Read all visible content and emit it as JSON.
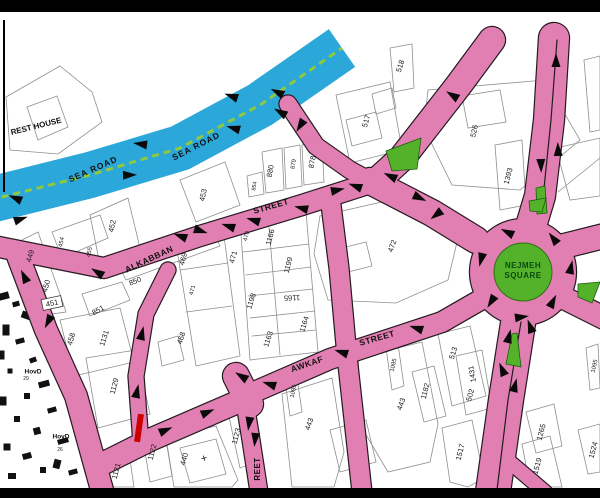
{
  "colors": {
    "road_pink": "#e27fb2",
    "casing": "#241a20",
    "sea_blue": "#2ba7da",
    "dash_green": "#8fc93e",
    "island_green": "#54b22a",
    "nejmeh_text": "#0b4a0e",
    "parcel_line": "#8f8f8f",
    "label": "#1c1c1c",
    "red": "#cc0000",
    "bar": "#000000",
    "paper": "#ffffff"
  },
  "map": {
    "sea_road": {
      "pts": "-10,200 90,175 180,148 260,105 342,48",
      "w": 46,
      "dash_w": 3,
      "dash_pattern": "7 5"
    },
    "roads": [
      {
        "pts": "-6,246 104,268 200,236 302,205 374,182",
        "w": 20
      },
      {
        "pts": "18,256 46,330 76,396 102,490",
        "w": 22
      },
      {
        "pts": "98,466 152,439 240,401",
        "w": 22
      },
      {
        "pts": "238,399 330,359 442,322 482,299",
        "w": 20
      },
      {
        "pts": "236,376 250,404",
        "w": 26
      },
      {
        "pts": "168,270 146,314 136,376 141,444",
        "w": 15
      },
      {
        "pts": "330,197 339,268 347,356 362,492",
        "w": 19
      },
      {
        "pts": "244,397 251,440 259,492",
        "w": 17
      },
      {
        "pts": "288,104 316,146 350,170 374,183",
        "w": 17
      },
      {
        "pts": "492,40 458,86 402,158 380,178",
        "w": 26
      },
      {
        "pts": "370,181 432,213 476,240",
        "w": 26
      },
      {
        "pts": "554,38 549,120 540,196 531,226",
        "w": 30
      },
      {
        "pts": "548,250 604,236",
        "w": 24
      },
      {
        "pts": "548,290 604,318",
        "w": 22
      },
      {
        "pts": "519,317 506,400 493,492",
        "w": 34
      },
      {
        "pts": "505,458 545,492",
        "w": 14
      }
    ],
    "center_lines": [
      {
        "pts": "557,40 551,120 543,198",
        "w": 1.2
      },
      {
        "pts": "521,322 508,400 497,490",
        "w": 1.2
      }
    ],
    "roundabout": {
      "cx": 523,
      "cy": 272,
      "r": 53,
      "green_r": 29,
      "line1": "NEJMEH",
      "line2": "SQUARE"
    },
    "islands": [
      "386,151 421,138 417,169 392,171",
      "536,188 545,186 547,213 537,214",
      "578,284 600,282 592,303 578,297",
      "512,334 517,333 521,367 506,364",
      "529,201 546,198 542,212 530,211"
    ],
    "arrows": [
      [
        140,
        144,
        188
      ],
      [
        130,
        175,
        358
      ],
      [
        15,
        198,
        203
      ],
      [
        21,
        219,
        341
      ],
      [
        233,
        128,
        196
      ],
      [
        231,
        96,
        200
      ],
      [
        277,
        92,
        207
      ],
      [
        280,
        112,
        210
      ],
      [
        97,
        272,
        212
      ],
      [
        180,
        236,
        200
      ],
      [
        201,
        231,
        18
      ],
      [
        228,
        226,
        198
      ],
      [
        253,
        220,
        197
      ],
      [
        301,
        208,
        194
      ],
      [
        338,
        190,
        348
      ],
      [
        355,
        186,
        200
      ],
      [
        390,
        176,
        205
      ],
      [
        420,
        198,
        25
      ],
      [
        436,
        215,
        142
      ],
      [
        300,
        126,
        122
      ],
      [
        452,
        95,
        212
      ],
      [
        556,
        60,
        270
      ],
      [
        558,
        149,
        268
      ],
      [
        541,
        166,
        88
      ],
      [
        507,
        232,
        206
      ],
      [
        553,
        238,
        232
      ],
      [
        481,
        260,
        104
      ],
      [
        491,
        302,
        122
      ],
      [
        522,
        317,
        352
      ],
      [
        553,
        301,
        297
      ],
      [
        571,
        267,
        282
      ],
      [
        509,
        336,
        284
      ],
      [
        502,
        369,
        247
      ],
      [
        515,
        385,
        284
      ],
      [
        530,
        326,
        250
      ],
      [
        341,
        352,
        198
      ],
      [
        269,
        384,
        198
      ],
      [
        416,
        328,
        198
      ],
      [
        241,
        376,
        212
      ],
      [
        249,
        424,
        98
      ],
      [
        255,
        440,
        96
      ],
      [
        208,
        412,
        337
      ],
      [
        166,
        430,
        337
      ],
      [
        142,
        333,
        283
      ],
      [
        137,
        391,
        282
      ],
      [
        24,
        276,
        244
      ],
      [
        48,
        322,
        117
      ]
    ],
    "street_labels": [
      {
        "t": "SEA ROAD",
        "x": 93,
        "y": 169,
        "r": -24,
        "s": 8.5,
        "ls": 1
      },
      {
        "t": "SEA ROAD",
        "x": 196,
        "y": 146,
        "r": -27,
        "s": 8.5,
        "ls": 1
      },
      {
        "t": "ALKABBAN",
        "x": 149,
        "y": 259,
        "r": -25,
        "s": 8.5,
        "ls": 0.5
      },
      {
        "t": "STREET",
        "x": 271,
        "y": 206,
        "r": -16,
        "s": 8.5,
        "ls": 0.5
      },
      {
        "t": "AWKAF",
        "x": 307,
        "y": 364,
        "r": -19,
        "s": 8.5,
        "ls": 0.5
      },
      {
        "t": "STREET",
        "x": 377,
        "y": 338,
        "r": -16,
        "s": 8.5,
        "ls": 0.5
      },
      {
        "t": "REET",
        "x": 257,
        "y": 469,
        "r": -90,
        "s": 8,
        "ls": 0.5
      },
      {
        "t": "REST HOUSE",
        "x": 36,
        "y": 126,
        "r": -14,
        "s": 8,
        "ls": 0
      },
      {
        "t": "HovD",
        "x": 33,
        "y": 371,
        "r": 0,
        "s": 6.5,
        "ls": 0
      },
      {
        "t": "HovD",
        "x": 61,
        "y": 436,
        "r": 0,
        "s": 6.5,
        "ls": 0
      }
    ],
    "parcel_labels": [
      {
        "t": "449",
        "x": 30,
        "y": 256,
        "r": -75
      },
      {
        "t": "450",
        "x": 46,
        "y": 286,
        "r": -75
      },
      {
        "t": "451",
        "x": 52,
        "y": 303,
        "r": -12,
        "box": true
      },
      {
        "t": "452",
        "x": 112,
        "y": 226,
        "r": -78
      },
      {
        "t": "453",
        "x": 203,
        "y": 195,
        "r": -78
      },
      {
        "t": "454",
        "x": 61,
        "y": 242,
        "r": -78,
        "s": 6
      },
      {
        "t": "455",
        "x": 89,
        "y": 252,
        "r": -78,
        "s": 6
      },
      {
        "t": "850",
        "x": 135,
        "y": 281,
        "r": -22
      },
      {
        "t": "851",
        "x": 98,
        "y": 310,
        "r": -30
      },
      {
        "t": "458",
        "x": 71,
        "y": 339,
        "r": -75
      },
      {
        "t": "1131",
        "x": 104,
        "y": 338,
        "r": -72
      },
      {
        "t": "1129",
        "x": 114,
        "y": 386,
        "r": -75
      },
      {
        "t": "468",
        "x": 181,
        "y": 338,
        "r": -72
      },
      {
        "t": "469",
        "x": 183,
        "y": 259,
        "r": -75
      },
      {
        "t": "471",
        "x": 233,
        "y": 257,
        "r": -75
      },
      {
        "t": "471",
        "x": 192,
        "y": 290,
        "r": -75,
        "s": 6
      },
      {
        "t": "470",
        "x": 246,
        "y": 236,
        "r": -75,
        "s": 6
      },
      {
        "t": "1166",
        "x": 270,
        "y": 237,
        "r": -75
      },
      {
        "t": "1199",
        "x": 288,
        "y": 265,
        "r": -75
      },
      {
        "t": "1198",
        "x": 251,
        "y": 301,
        "r": -72
      },
      {
        "t": "1165",
        "x": 292,
        "y": 298,
        "r": 178
      },
      {
        "t": "1164",
        "x": 304,
        "y": 324,
        "r": -72
      },
      {
        "t": "1163",
        "x": 268,
        "y": 339,
        "r": -72
      },
      {
        "t": "472",
        "x": 392,
        "y": 246,
        "r": -70
      },
      {
        "t": "880",
        "x": 270,
        "y": 171,
        "r": -80
      },
      {
        "t": "879",
        "x": 293,
        "y": 164,
        "r": -80,
        "s": 6
      },
      {
        "t": "878",
        "x": 312,
        "y": 162,
        "r": -80
      },
      {
        "t": "854",
        "x": 254,
        "y": 186,
        "r": -80,
        "s": 5.5
      },
      {
        "t": "518",
        "x": 400,
        "y": 66,
        "r": -72
      },
      {
        "t": "517",
        "x": 366,
        "y": 121,
        "r": -75
      },
      {
        "t": "526",
        "x": 474,
        "y": 131,
        "r": -78
      },
      {
        "t": "1393",
        "x": 508,
        "y": 176,
        "r": -75
      },
      {
        "t": "443",
        "x": 309,
        "y": 424,
        "r": -70
      },
      {
        "t": "443",
        "x": 401,
        "y": 404,
        "r": -70
      },
      {
        "t": "1095",
        "x": 293,
        "y": 391,
        "r": -78,
        "s": 6
      },
      {
        "t": "1095",
        "x": 393,
        "y": 365,
        "r": -78,
        "s": 6
      },
      {
        "t": "1095",
        "x": 594,
        "y": 366,
        "r": -78,
        "s": 6
      },
      {
        "t": "1123",
        "x": 236,
        "y": 436,
        "r": -75
      },
      {
        "t": "1122",
        "x": 152,
        "y": 452,
        "r": -75
      },
      {
        "t": "1121",
        "x": 116,
        "y": 471,
        "r": -75
      },
      {
        "t": "440",
        "x": 184,
        "y": 459,
        "r": -75
      },
      {
        "t": "+",
        "x": 204,
        "y": 458,
        "r": -15,
        "s": 11
      },
      {
        "t": "513",
        "x": 453,
        "y": 353,
        "r": -72
      },
      {
        "t": "1431",
        "x": 472,
        "y": 374,
        "r": -100
      },
      {
        "t": "502",
        "x": 470,
        "y": 395,
        "r": -75
      },
      {
        "t": "1182",
        "x": 425,
        "y": 391,
        "r": -75
      },
      {
        "t": "1517",
        "x": 460,
        "y": 452,
        "r": -75
      },
      {
        "t": "1519",
        "x": 537,
        "y": 466,
        "r": -75
      },
      {
        "t": "1265",
        "x": 541,
        "y": 432,
        "r": -75
      },
      {
        "t": "1524",
        "x": 593,
        "y": 450,
        "r": -75
      },
      {
        "t": "29",
        "x": 26,
        "y": 378,
        "r": 0,
        "s": 5
      },
      {
        "t": "26",
        "x": 60,
        "y": 449,
        "r": 0,
        "s": 5
      }
    ],
    "parcels": [
      "6,97 60,66 92,92 102,122 58,154 10,150",
      "27,107 57,96 68,127 38,140",
      "22,240 38,232 62,300 66,312 44,315 30,282",
      "90,215 128,198 140,248 100,265",
      "180,180 225,162 240,205 196,222",
      "52,232 100,215 108,238 62,258",
      "262,152 282,148 284,190 266,193",
      "284,148 300,145 302,186 286,189",
      "302,145 322,142 324,182 304,185",
      "247,176 262,172 264,194 249,197",
      "390,48 412,44 414,88 394,92",
      "336,95 390,82 402,150 350,163",
      "428,90 545,80 580,140 520,190 452,185 424,128",
      "495,145 522,140 526,205 500,210",
      "320,216 408,196 458,238 448,280 396,303 328,300 314,254",
      "240,220 306,212 318,352 250,360",
      "176,244 224,236 240,356 196,366",
      "60,320 120,308 134,362 74,376",
      "86,358 136,350 150,414 98,428",
      "116,260 212,230 220,246 126,280",
      "82,294 122,282 130,300 90,316",
      "282,394 332,378 344,452 334,487 292,487",
      "358,358 422,342 438,424 430,462 388,472 362,428",
      "284,374 296,370 302,412 290,416",
      "386,348 398,344 404,386 392,390",
      "228,412 246,406 256,462 240,468",
      "142,434 164,428 172,476 150,482",
      "104,452 128,446 134,487 108,487",
      "166,438 216,426 238,480 232,487 174,487",
      "180,448 216,439 226,474 190,483",
      "438,334 470,326 486,396 452,406",
      "456,356 482,350 492,408 466,415",
      "412,372 434,366 446,416 424,422",
      "442,428 472,420 484,478 468,487 450,482",
      "522,444 550,436 562,487 530,487",
      "526,412 554,404 562,446 536,453",
      "578,430 600,424 600,472 588,474",
      "586,348 598,344 600,388 590,390",
      "556,148 600,138 600,196 570,200",
      "584,60 600,56 600,130 590,132",
      "346,120 376,112 382,138 352,146",
      "372,94 392,88 396,108 376,114",
      "462,96 500,90 506,122 468,128",
      "334,250 366,242 372,266 340,274",
      "158,342 178,336 184,360 162,366",
      "330,430 366,420 376,462 340,472"
    ],
    "plines": [
      "243,252 309,244",
      "246,275 311,267",
      "248,296 313,289",
      "250,318 315,311",
      "252,336 316,330",
      "268,216 280,355",
      "180,270 228,263",
      "186,312 232,306",
      "558,192 600,158"
    ],
    "black_buildings": [
      [
        4,
        296,
        10,
        7,
        -15
      ],
      [
        16,
        304,
        7,
        5,
        -15
      ],
      [
        28,
        316,
        13,
        7,
        20
      ],
      [
        6,
        330,
        7,
        11,
        0
      ],
      [
        20,
        341,
        9,
        5,
        -15
      ],
      [
        2,
        355,
        5,
        9,
        0
      ],
      [
        33,
        360,
        7,
        5,
        -20
      ],
      [
        10,
        371,
        5,
        5,
        0
      ],
      [
        44,
        384,
        11,
        6,
        -15
      ],
      [
        27,
        396,
        6,
        6,
        0
      ],
      [
        3,
        401,
        7,
        9,
        0
      ],
      [
        52,
        410,
        9,
        5,
        -15
      ],
      [
        17,
        419,
        6,
        6,
        0
      ],
      [
        37,
        431,
        7,
        7,
        -15
      ],
      [
        63,
        441,
        11,
        5,
        -15
      ],
      [
        7,
        447,
        7,
        7,
        0
      ],
      [
        27,
        456,
        9,
        6,
        -15
      ],
      [
        57,
        464,
        7,
        9,
        15
      ],
      [
        73,
        472,
        9,
        5,
        -15
      ],
      [
        12,
        476,
        8,
        6,
        0
      ],
      [
        43,
        470,
        6,
        6,
        0
      ],
      [
        80,
        425,
        6,
        9,
        70
      ]
    ],
    "red_line": {
      "x": 139,
      "y": 428,
      "w": 6,
      "h": 28,
      "r": 8
    },
    "edge_line": {
      "x": 3,
      "y": 20,
      "w": 2,
      "h": 172
    }
  }
}
